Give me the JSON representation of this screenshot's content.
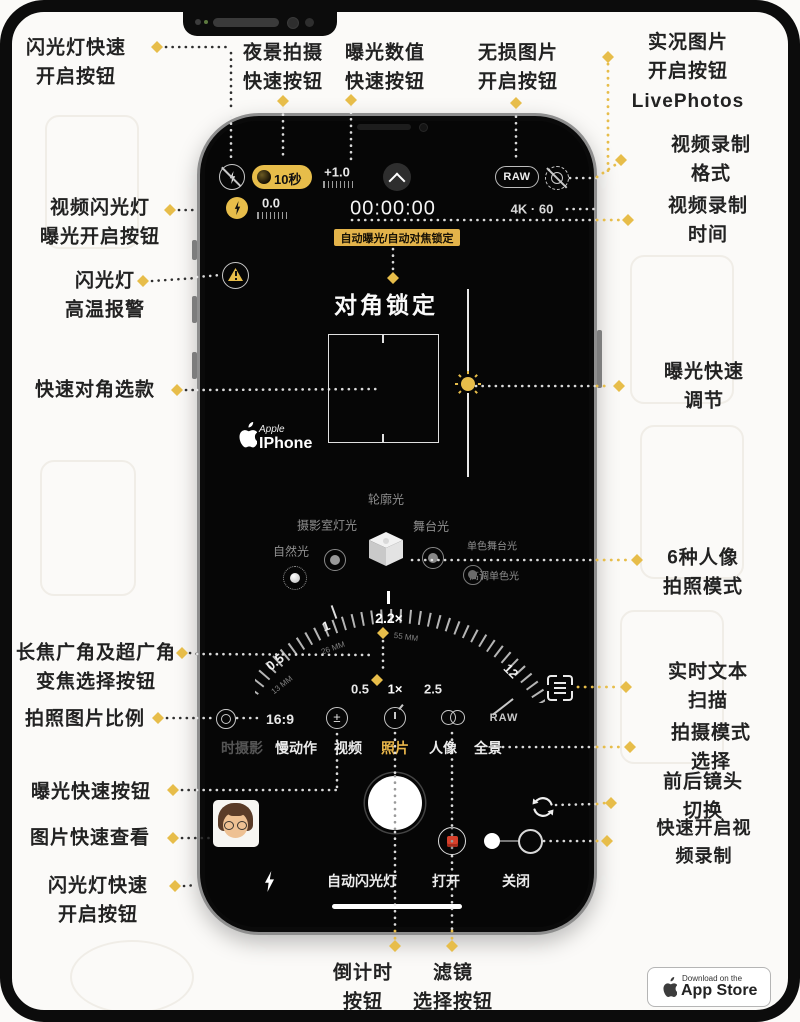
{
  "colors": {
    "accent_yellow": "#e7bd4a",
    "badge_yellow": "#e3b34a",
    "selected_yellow": "#e9b64a",
    "filter_red": "#d6402b"
  },
  "annotations": {
    "flash_quick_open_top": "闪光灯快速\n开启按钮",
    "night_mode_quick": "夜景拍摄\n快速按钮",
    "exposure_value_quick": "曝光数值\n快速按钮",
    "lossless_image": "无损图片\n开启按钮",
    "live_photos": "实况图片\n开启按钮\nLivePhotos",
    "video_format": "视频录制格式",
    "video_time": "视频录制时间",
    "video_flash_exposure": "视频闪光灯\n曝光开启按钮",
    "flash_temp_warning": "闪光灯\n高温报警",
    "quick_diagonal": "快速对角选款",
    "exposure_adjust": "曝光快速调节",
    "portrait_modes_6": "6种人像\n拍照模式",
    "zoom_lens_select": "长焦广角及超广角\n变焦选择按钮",
    "live_text_scan": "实时文本扫描",
    "photo_ratio": "拍照图片比例",
    "shoot_mode_select": "拍摄模式选择",
    "exposure_quick_btn": "曝光快速按钮",
    "camera_flip": "前后镜头切换",
    "photo_quick_view": "图片快速查看",
    "quick_video_record": "快速开启视频录制",
    "flash_quick_open_bottom": "闪光灯快速\n开启按钮",
    "countdown_btn": "倒计时\n按钮",
    "filter_select_btn": "滤镜\n选择按钮"
  },
  "phone": {
    "topbar": {
      "night_timer": "10秒",
      "ev": "+1.0",
      "raw": "RAW"
    },
    "statusbar": {
      "ev2": "0.0",
      "time": "00:00:00",
      "format": "4K · 60"
    },
    "ae_af_badge": "自动曝光/自动对焦锁定",
    "diagonal_lock": "对角锁定",
    "brand": {
      "apple": "Apple",
      "iphone": "IPhone"
    },
    "portrait": {
      "contour": "轮廓光",
      "studio": "摄影室灯光",
      "stage": "舞台光",
      "stage_mono": "单色舞台光",
      "natural": "自然光",
      "high_key": "高调单色光"
    },
    "dial": {
      "current": "2.2×",
      "mm_current": "55 MM",
      "one": "1",
      "mm_one": "26 MM",
      "half": "0.5",
      "mm_half": "13 MM",
      "max": "12"
    },
    "zoom_buttons": [
      "0.5",
      "1×",
      "2.5"
    ],
    "toolbar": {
      "ratio": "16:9",
      "plusminus": "±",
      "raw_off": "RAW"
    },
    "modes": [
      "时摄影",
      "慢动作",
      "视频",
      "照片",
      "人像",
      "全景"
    ],
    "bottom": {
      "auto_flash": "自动闪光灯",
      "on": "打开",
      "off": "关闭"
    }
  },
  "app_store": {
    "line1": "Download on the",
    "line2": "App Store"
  }
}
